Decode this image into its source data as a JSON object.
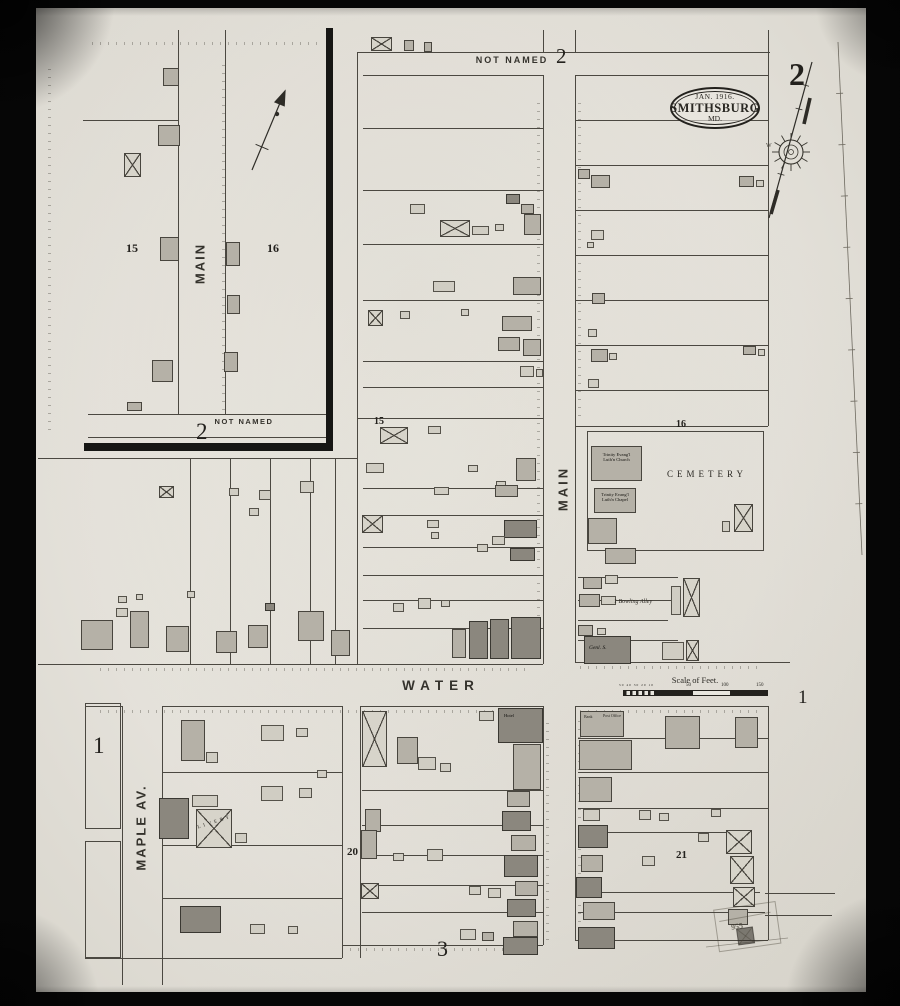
{
  "sheet": {
    "number_large": "2",
    "title_line1": "JAN. 1916.",
    "title_line2": "SMITHSBURG",
    "title_line3": "MD."
  },
  "streets": {
    "not_named": "NOT NAMED",
    "main": "MAIN",
    "water": "WATER",
    "maple": "MAPLE AV."
  },
  "blocks": {
    "sheet_large": "2",
    "top_sheet": "2",
    "inset_sheet": "2",
    "water_sheet": "1",
    "inset_15": "15",
    "inset_16": "16",
    "b15": "15",
    "b16": "16",
    "b1": "1",
    "b20": "20",
    "b21": "21",
    "b3": "3"
  },
  "landmarks": {
    "church_line1": "Trinity Evang'l",
    "church_line2": "Luth'n Church",
    "chapel_line1": "Trinity Evang'l",
    "chapel_line2": "Luth'n Chapel",
    "cemetery": "CEMETERY",
    "bowling_alley": "1 Bowling Alley",
    "livery": "LIVERY",
    "hotel": "Hotel",
    "bank": "Bank",
    "post_office": "Post Office",
    "general_store": "Genl. S.",
    "stamp_number": "955",
    "compass_west": "W"
  },
  "scale": {
    "label": "Scale of Feet.",
    "sub": "50 40 30 20 10",
    "ticks": [
      "50",
      "100",
      "150"
    ]
  },
  "map": {
    "buildings": [
      [
        163,
        68,
        16,
        18,
        "m"
      ],
      [
        158,
        125,
        22,
        21,
        "m"
      ],
      [
        124,
        153,
        17,
        24,
        "x"
      ],
      [
        160,
        237,
        19,
        24,
        "m"
      ],
      [
        152,
        360,
        21,
        22,
        "m"
      ],
      [
        127,
        402,
        15,
        9,
        "m"
      ],
      [
        226,
        242,
        14,
        24,
        "m"
      ],
      [
        227,
        295,
        13,
        19,
        "m"
      ],
      [
        224,
        352,
        14,
        20,
        "m"
      ],
      [
        371,
        37,
        21,
        14,
        "x"
      ],
      [
        404,
        40,
        10,
        11,
        "m"
      ],
      [
        424,
        42,
        8,
        10,
        "m"
      ],
      [
        506,
        194,
        14,
        10,
        "d"
      ],
      [
        521,
        204,
        13,
        10,
        "m"
      ],
      [
        410,
        204,
        15,
        10,
        "l"
      ],
      [
        440,
        220,
        30,
        17,
        "x"
      ],
      [
        472,
        226,
        17,
        9,
        "l"
      ],
      [
        495,
        224,
        9,
        7,
        "l"
      ],
      [
        524,
        214,
        17,
        21,
        "m"
      ],
      [
        433,
        281,
        22,
        11,
        "l"
      ],
      [
        513,
        277,
        28,
        18,
        "m"
      ],
      [
        368,
        310,
        15,
        16,
        "x"
      ],
      [
        400,
        311,
        10,
        8,
        "l"
      ],
      [
        502,
        316,
        30,
        15,
        "m"
      ],
      [
        498,
        337,
        22,
        14,
        "m"
      ],
      [
        523,
        339,
        18,
        17,
        "m"
      ],
      [
        520,
        366,
        14,
        11,
        "l"
      ],
      [
        536,
        369,
        7,
        8,
        "l"
      ],
      [
        461,
        309,
        8,
        7,
        "l"
      ],
      [
        380,
        427,
        28,
        17,
        "x"
      ],
      [
        428,
        426,
        13,
        8,
        "l"
      ],
      [
        366,
        463,
        18,
        10,
        "l"
      ],
      [
        468,
        465,
        10,
        7,
        "l"
      ],
      [
        516,
        458,
        20,
        23,
        "m"
      ],
      [
        496,
        481,
        10,
        9,
        "l"
      ],
      [
        434,
        487,
        15,
        8,
        "l"
      ],
      [
        495,
        485,
        23,
        12,
        "m"
      ],
      [
        362,
        515,
        21,
        18,
        "x"
      ],
      [
        427,
        520,
        12,
        8,
        "l"
      ],
      [
        431,
        532,
        8,
        7,
        "l"
      ],
      [
        504,
        520,
        33,
        18,
        "d"
      ],
      [
        492,
        536,
        13,
        9,
        "l"
      ],
      [
        510,
        548,
        25,
        13,
        "d"
      ],
      [
        477,
        544,
        11,
        8,
        "l"
      ],
      [
        393,
        603,
        11,
        9,
        "l"
      ],
      [
        418,
        598,
        13,
        11,
        "l"
      ],
      [
        441,
        600,
        9,
        7,
        "l"
      ],
      [
        452,
        629,
        14,
        29,
        "m"
      ],
      [
        469,
        621,
        19,
        38,
        "d"
      ],
      [
        490,
        619,
        19,
        40,
        "d"
      ],
      [
        511,
        617,
        30,
        42,
        "d"
      ],
      [
        578,
        169,
        12,
        10,
        "m"
      ],
      [
        591,
        175,
        19,
        13,
        "m"
      ],
      [
        739,
        176,
        15,
        11,
        "m"
      ],
      [
        756,
        180,
        8,
        7,
        "l"
      ],
      [
        591,
        230,
        13,
        10,
        "l"
      ],
      [
        587,
        242,
        7,
        6,
        "l"
      ],
      [
        592,
        293,
        13,
        11,
        "m"
      ],
      [
        588,
        329,
        9,
        8,
        "l"
      ],
      [
        591,
        349,
        17,
        13,
        "m"
      ],
      [
        609,
        353,
        8,
        7,
        "l"
      ],
      [
        588,
        379,
        11,
        9,
        "l"
      ],
      [
        743,
        346,
        13,
        9,
        "m"
      ],
      [
        758,
        349,
        7,
        7,
        "l"
      ],
      [
        587,
        431,
        177,
        120,
        "o"
      ],
      [
        591,
        446,
        51,
        35,
        "m"
      ],
      [
        594,
        488,
        42,
        25,
        "m"
      ],
      [
        588,
        518,
        29,
        26,
        "m"
      ],
      [
        605,
        548,
        31,
        16,
        "m"
      ],
      [
        734,
        504,
        19,
        28,
        "x"
      ],
      [
        722,
        521,
        8,
        11,
        "l"
      ],
      [
        583,
        577,
        19,
        12,
        "m"
      ],
      [
        605,
        575,
        13,
        9,
        "l"
      ],
      [
        671,
        586,
        10,
        29,
        "l"
      ],
      [
        683,
        578,
        17,
        39,
        "x"
      ],
      [
        579,
        594,
        21,
        13,
        "m"
      ],
      [
        601,
        596,
        15,
        9,
        "l"
      ],
      [
        578,
        625,
        15,
        11,
        "m"
      ],
      [
        597,
        628,
        9,
        7,
        "l"
      ],
      [
        584,
        636,
        47,
        28,
        "d"
      ],
      [
        662,
        642,
        22,
        18,
        "l"
      ],
      [
        686,
        640,
        13,
        21,
        "x"
      ],
      [
        159,
        486,
        15,
        12,
        "x"
      ],
      [
        229,
        488,
        10,
        8,
        "l"
      ],
      [
        259,
        490,
        12,
        10,
        "l"
      ],
      [
        300,
        481,
        14,
        12,
        "l"
      ],
      [
        249,
        508,
        10,
        8,
        "l"
      ],
      [
        81,
        620,
        32,
        30,
        "m"
      ],
      [
        116,
        608,
        12,
        9,
        "l"
      ],
      [
        130,
        611,
        19,
        37,
        "m"
      ],
      [
        166,
        626,
        23,
        26,
        "m"
      ],
      [
        216,
        631,
        21,
        22,
        "m"
      ],
      [
        248,
        625,
        20,
        23,
        "m"
      ],
      [
        265,
        603,
        10,
        8,
        "d"
      ],
      [
        298,
        611,
        26,
        30,
        "m"
      ],
      [
        331,
        630,
        19,
        26,
        "m"
      ],
      [
        118,
        596,
        9,
        7,
        "l"
      ],
      [
        136,
        594,
        7,
        6,
        "l"
      ],
      [
        187,
        591,
        8,
        7,
        "l"
      ],
      [
        85,
        703,
        36,
        126,
        "o"
      ],
      [
        85,
        841,
        36,
        117,
        "o"
      ],
      [
        181,
        720,
        24,
        41,
        "m"
      ],
      [
        206,
        752,
        12,
        11,
        "l"
      ],
      [
        261,
        725,
        23,
        16,
        "l"
      ],
      [
        296,
        728,
        12,
        9,
        "l"
      ],
      [
        159,
        798,
        30,
        41,
        "d"
      ],
      [
        192,
        795,
        26,
        12,
        "l"
      ],
      [
        196,
        809,
        36,
        39,
        "x"
      ],
      [
        235,
        833,
        12,
        10,
        "l"
      ],
      [
        261,
        786,
        22,
        15,
        "l"
      ],
      [
        299,
        788,
        13,
        10,
        "l"
      ],
      [
        317,
        770,
        10,
        8,
        "l"
      ],
      [
        180,
        906,
        41,
        27,
        "d"
      ],
      [
        250,
        924,
        15,
        10,
        "l"
      ],
      [
        288,
        926,
        10,
        8,
        "l"
      ],
      [
        362,
        711,
        25,
        56,
        "x"
      ],
      [
        479,
        711,
        15,
        10,
        "l"
      ],
      [
        498,
        708,
        45,
        35,
        "d"
      ],
      [
        513,
        744,
        28,
        46,
        "m"
      ],
      [
        397,
        737,
        21,
        27,
        "m"
      ],
      [
        418,
        757,
        18,
        13,
        "l"
      ],
      [
        440,
        763,
        11,
        9,
        "l"
      ],
      [
        365,
        809,
        16,
        23,
        "m"
      ],
      [
        361,
        830,
        16,
        29,
        "m"
      ],
      [
        361,
        883,
        18,
        16,
        "x"
      ],
      [
        427,
        849,
        16,
        12,
        "l"
      ],
      [
        393,
        853,
        11,
        8,
        "l"
      ],
      [
        469,
        886,
        12,
        9,
        "l"
      ],
      [
        488,
        888,
        13,
        10,
        "l"
      ],
      [
        507,
        791,
        23,
        16,
        "m"
      ],
      [
        502,
        811,
        29,
        20,
        "d"
      ],
      [
        511,
        835,
        25,
        16,
        "m"
      ],
      [
        504,
        855,
        34,
        22,
        "d"
      ],
      [
        515,
        881,
        23,
        15,
        "m"
      ],
      [
        507,
        899,
        29,
        18,
        "d"
      ],
      [
        513,
        921,
        25,
        16,
        "m"
      ],
      [
        503,
        937,
        35,
        18,
        "d"
      ],
      [
        460,
        929,
        16,
        11,
        "l"
      ],
      [
        482,
        932,
        12,
        9,
        "m"
      ],
      [
        580,
        711,
        44,
        26,
        "m"
      ],
      [
        579,
        740,
        53,
        30,
        "m"
      ],
      [
        579,
        777,
        33,
        25,
        "m"
      ],
      [
        665,
        716,
        35,
        33,
        "m"
      ],
      [
        735,
        717,
        23,
        31,
        "m"
      ],
      [
        583,
        809,
        17,
        12,
        "l"
      ],
      [
        639,
        810,
        12,
        10,
        "l"
      ],
      [
        659,
        813,
        10,
        8,
        "l"
      ],
      [
        711,
        809,
        10,
        8,
        "l"
      ],
      [
        578,
        825,
        30,
        23,
        "d"
      ],
      [
        581,
        855,
        22,
        17,
        "m"
      ],
      [
        576,
        877,
        26,
        21,
        "d"
      ],
      [
        583,
        902,
        32,
        18,
        "m"
      ],
      [
        578,
        927,
        37,
        22,
        "d"
      ],
      [
        726,
        830,
        26,
        24,
        "x"
      ],
      [
        730,
        856,
        24,
        28,
        "x"
      ],
      [
        733,
        887,
        22,
        20,
        "x"
      ],
      [
        728,
        909,
        20,
        16,
        "m"
      ],
      [
        698,
        833,
        11,
        9,
        "l"
      ],
      [
        642,
        856,
        13,
        10,
        "l"
      ]
    ],
    "lines": [
      [
        543,
        30,
        1,
        22
      ],
      [
        575,
        30,
        1,
        22
      ],
      [
        543,
        75,
        1,
        589
      ],
      [
        575,
        75,
        1,
        587
      ],
      [
        543,
        706,
        1,
        239
      ],
      [
        575,
        706,
        1,
        234
      ],
      [
        357,
        52,
        1,
        612
      ],
      [
        122,
        706,
        1,
        279
      ],
      [
        162,
        706,
        1,
        279
      ],
      [
        342,
        706,
        1,
        252
      ],
      [
        360,
        706,
        1,
        252
      ],
      [
        768,
        30,
        1,
        396
      ],
      [
        768,
        706,
        1,
        234
      ],
      [
        178,
        30,
        1,
        385
      ],
      [
        225,
        30,
        1,
        385
      ],
      [
        190,
        458,
        1,
        206
      ],
      [
        230,
        458,
        1,
        206
      ],
      [
        270,
        458,
        1,
        206
      ],
      [
        310,
        458,
        1,
        206
      ],
      [
        335,
        458,
        1,
        206
      ],
      [
        358,
        52,
        412,
        1
      ],
      [
        363,
        75,
        180,
        1
      ],
      [
        575,
        75,
        193,
        1
      ],
      [
        363,
        128,
        180,
        1
      ],
      [
        363,
        190,
        180,
        1
      ],
      [
        363,
        244,
        180,
        1
      ],
      [
        363,
        300,
        180,
        1
      ],
      [
        363,
        361,
        180,
        1
      ],
      [
        363,
        387,
        180,
        1
      ],
      [
        357,
        418,
        186,
        1
      ],
      [
        363,
        488,
        180,
        1
      ],
      [
        363,
        515,
        180,
        1
      ],
      [
        363,
        547,
        180,
        1
      ],
      [
        363,
        575,
        180,
        1
      ],
      [
        363,
        600,
        180,
        1
      ],
      [
        363,
        628,
        180,
        1
      ],
      [
        575,
        120,
        193,
        1
      ],
      [
        575,
        165,
        193,
        1
      ],
      [
        575,
        210,
        193,
        1
      ],
      [
        575,
        255,
        193,
        1
      ],
      [
        575,
        300,
        193,
        1
      ],
      [
        575,
        345,
        193,
        1
      ],
      [
        575,
        390,
        193,
        1
      ],
      [
        575,
        426,
        193,
        1
      ],
      [
        578,
        577,
        100,
        1
      ],
      [
        578,
        600,
        95,
        1
      ],
      [
        578,
        620,
        90,
        1
      ],
      [
        578,
        640,
        100,
        1
      ],
      [
        38,
        664,
        505,
        1
      ],
      [
        575,
        662,
        215,
        1
      ],
      [
        85,
        706,
        37,
        1
      ],
      [
        162,
        706,
        180,
        1
      ],
      [
        360,
        706,
        183,
        1
      ],
      [
        575,
        706,
        193,
        1
      ],
      [
        362,
        790,
        181,
        1
      ],
      [
        362,
        825,
        181,
        1
      ],
      [
        362,
        855,
        181,
        1
      ],
      [
        362,
        885,
        181,
        1
      ],
      [
        362,
        912,
        181,
        1
      ],
      [
        342,
        945,
        201,
        1
      ],
      [
        85,
        958,
        257,
        1
      ],
      [
        575,
        940,
        193,
        1
      ],
      [
        163,
        772,
        179,
        1
      ],
      [
        163,
        845,
        179,
        1
      ],
      [
        163,
        898,
        179,
        1
      ],
      [
        578,
        738,
        190,
        1
      ],
      [
        578,
        772,
        190,
        1
      ],
      [
        578,
        808,
        190,
        1
      ],
      [
        578,
        832,
        167,
        1
      ],
      [
        578,
        892,
        182,
        1
      ],
      [
        578,
        912,
        187,
        1
      ],
      [
        765,
        893,
        70,
        1
      ],
      [
        765,
        915,
        67,
        1
      ],
      [
        88,
        414,
        242,
        1
      ],
      [
        88,
        437,
        242,
        1
      ],
      [
        83,
        120,
        95,
        1
      ],
      [
        38,
        458,
        319,
        1
      ]
    ],
    "ticks": [
      [
        92,
        42,
        230,
        "h"
      ],
      [
        48,
        62,
        368,
        "v"
      ],
      [
        222,
        60,
        350,
        "v"
      ],
      [
        100,
        668,
        430,
        "h"
      ],
      [
        580,
        666,
        180,
        "h"
      ],
      [
        100,
        710,
        420,
        "h"
      ],
      [
        580,
        710,
        180,
        "h"
      ],
      [
        350,
        948,
        190,
        "h"
      ],
      [
        537,
        100,
        540,
        "v"
      ],
      [
        578,
        96,
        320,
        "v"
      ],
      [
        546,
        720,
        220,
        "v"
      ],
      [
        578,
        720,
        210,
        "v"
      ]
    ]
  }
}
